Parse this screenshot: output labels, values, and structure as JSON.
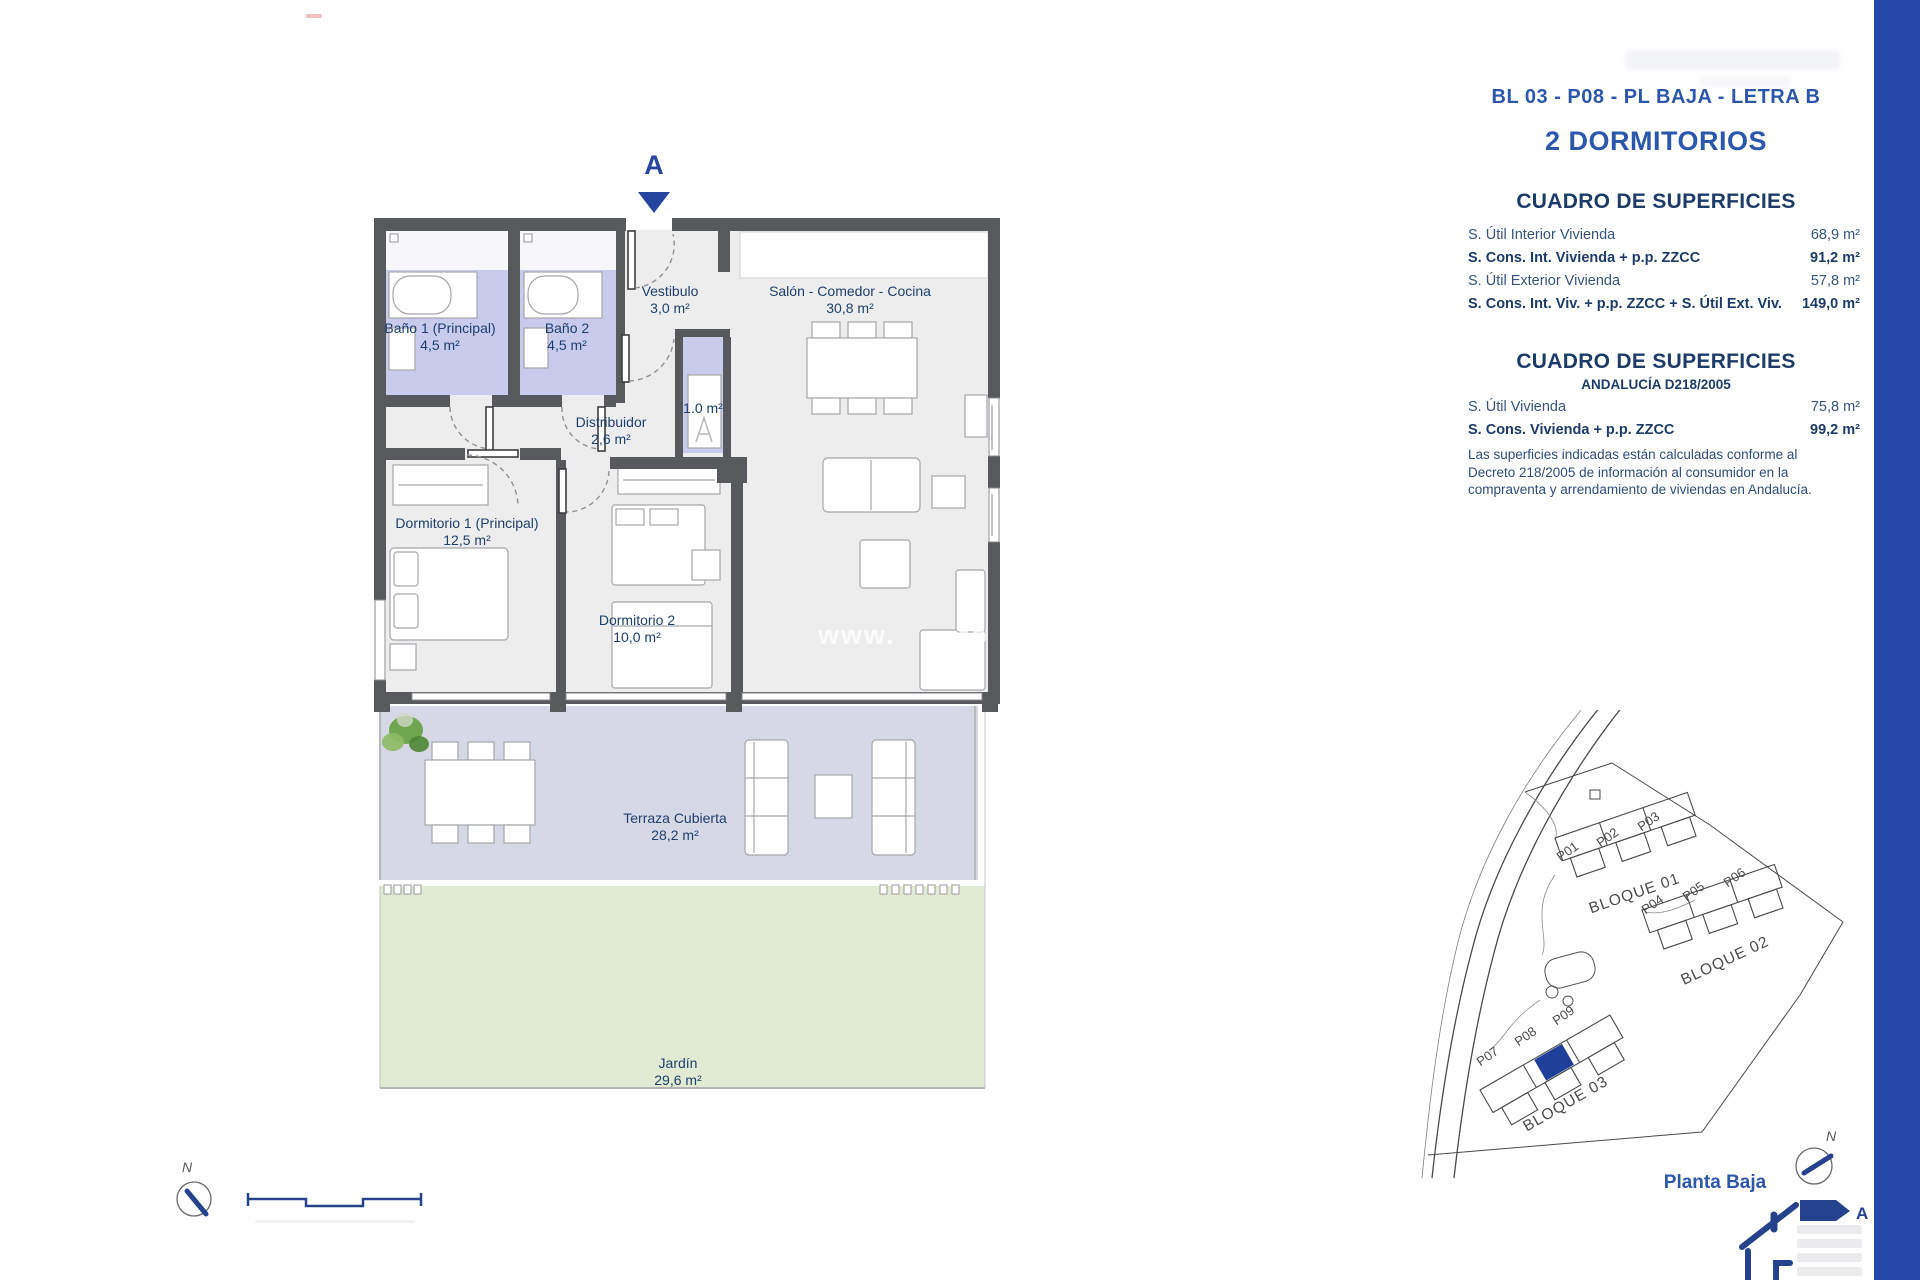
{
  "right_panel": {
    "unit_title": "BL 03 - P08 - PL BAJA - LETRA B",
    "bedrooms_title": "2 DORMITORIOS",
    "table1": {
      "title": "CUADRO DE SUPERFICIES",
      "rows": [
        {
          "label": "S. Útil Interior Vivienda",
          "value": "68,9 m²"
        },
        {
          "label": "S. Cons. Int. Vivienda + p.p. ZZCC",
          "value": "91,2 m²"
        },
        {
          "label": "S. Útil Exterior Vivienda",
          "value": "57,8 m²"
        },
        {
          "label": "S. Cons. Int. Viv. + p.p. ZZCC + S. Útil Ext. Viv.",
          "value": "149,0 m²"
        }
      ]
    },
    "table2": {
      "title": "CUADRO DE SUPERFICIES",
      "subtitle": "ANDALUCÍA D218/2005",
      "rows": [
        {
          "label": "S. Útil Vivienda",
          "value": "75,8 m²"
        },
        {
          "label": "S. Cons. Vivienda + p.p. ZZCC",
          "value": "99,2 m²"
        }
      ],
      "disclaimer": "Las superficies indicadas están calculadas conforme al Decreto 218/2005 de información al consumidor en la compraventa y arrendamiento de viviendas en Andalucía."
    },
    "floor_label": "Planta Baja"
  },
  "floor_plan": {
    "section_marker": "A",
    "compass_label": "N",
    "rooms": {
      "bano1": {
        "name": "Baño 1 (Principal)",
        "area": "4,5 m²"
      },
      "bano2": {
        "name": "Baño 2",
        "area": "4,5 m²"
      },
      "vestibulo": {
        "name": "Vestibulo",
        "area": "3,0 m²"
      },
      "salon": {
        "name": "Salón - Comedor - Cocina",
        "area": "30,8 m²"
      },
      "distribuidor": {
        "name": "Distribuidor",
        "area": "2,6 m²"
      },
      "lavadero": {
        "area": "1.0 m²"
      },
      "dormitorio1": {
        "name": "Dormitorio 1 (Principal)",
        "area": "12,5 m²"
      },
      "dormitorio2": {
        "name": "Dormitorio 2",
        "area": "10,0 m²"
      },
      "terraza": {
        "name": "Terraza Cubierta",
        "area": "28,2 m²"
      },
      "jardin": {
        "name": "Jardín",
        "area": "29,6 m²"
      }
    }
  },
  "site_plan": {
    "compass_label": "N",
    "blocks": [
      {
        "name": "BLOQUE 01",
        "units": [
          "P01",
          "P02",
          "P03"
        ]
      },
      {
        "name": "BLOQUE 02",
        "units": [
          "P04",
          "P05",
          "P06"
        ]
      },
      {
        "name": "BLOQUE 03",
        "units": [
          "P07",
          "P08",
          "P09"
        ]
      }
    ]
  },
  "energy_logo": {
    "rating_letter": "A"
  },
  "watermark": {
    "prefix": "www.",
    "suffix": "to"
  },
  "colors": {
    "accent_blue": "#2b58ab",
    "navy": "#1d3c6a",
    "sidebar_blue": "#2447a9",
    "wall_gray": "#58595c",
    "bath_lavender": "#c9cbec",
    "terrace_lavender": "#d6d8e5",
    "garden_green": "#e1ead3",
    "highlight_unit_blue": "#1e3f9a"
  }
}
